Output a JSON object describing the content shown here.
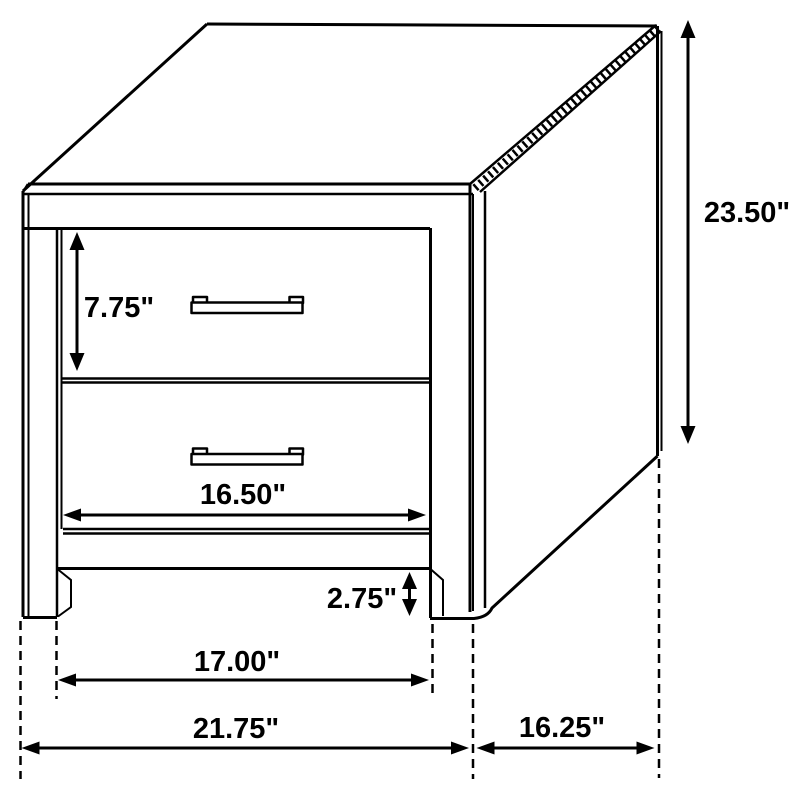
{
  "figure": {
    "subject": "Two-drawer nightstand dimension line drawing",
    "ink_color": "#000000",
    "background_color": "#ffffff"
  },
  "dimensions": [
    {
      "id": "drawer-height",
      "label": "7.75\"",
      "value": 7.75,
      "unit": "inches",
      "orientation": "vertical"
    },
    {
      "id": "drawer-width",
      "label": "16.50\"",
      "value": 16.5,
      "unit": "inches",
      "orientation": "horizontal"
    },
    {
      "id": "toe-kick-height",
      "label": "2.75\"",
      "value": 2.75,
      "unit": "inches",
      "orientation": "vertical"
    },
    {
      "id": "inner-width",
      "label": "17.00\"",
      "value": 17.0,
      "unit": "inches",
      "orientation": "horizontal"
    },
    {
      "id": "overall-width",
      "label": "21.75\"",
      "value": 21.75,
      "unit": "inches",
      "orientation": "horizontal"
    },
    {
      "id": "depth",
      "label": "16.25\"",
      "value": 16.25,
      "unit": "inches",
      "orientation": "horizontal"
    },
    {
      "id": "overall-height",
      "label": "23.50\"",
      "value": 23.5,
      "unit": "inches",
      "orientation": "vertical"
    }
  ]
}
